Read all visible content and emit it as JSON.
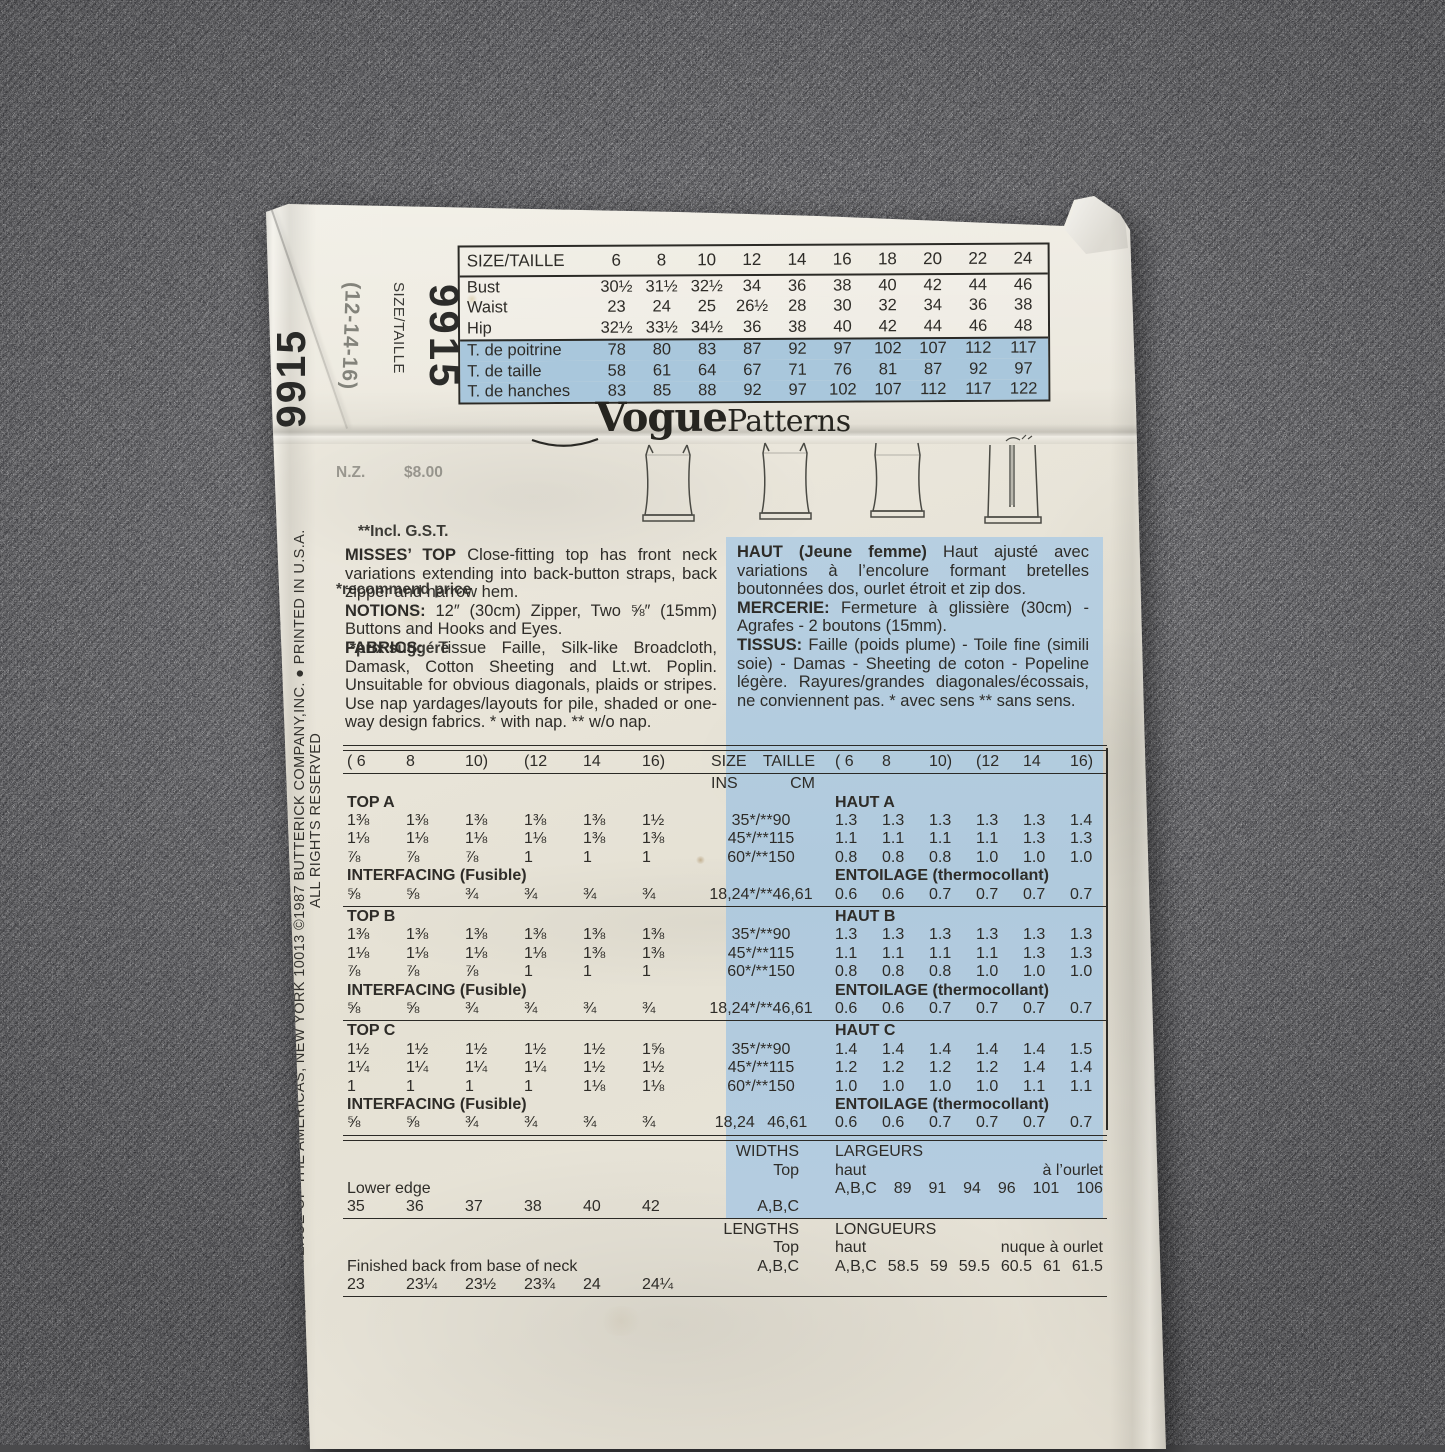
{
  "flap": {
    "pattern_number": "9915",
    "size_label": "SIZE/TAILLE",
    "size_range": "(12-14-16)"
  },
  "edge": {
    "pattern_number": "9915",
    "address_line1": "PATTERN SERVICE, 161 AVENUE OF THE AMERICAS, NEW YORK 10013   ©1987 BUTTERICK COMPANY,INC. ● PRINTED IN U.S.A.",
    "address_line2": "ALL RIGHTS RESERVED"
  },
  "brand": {
    "logo_bold": "Vogue",
    "logo_regular": "Patterns"
  },
  "price": {
    "line0": "N.Z.         $8.00",
    "line1": "**Incl. G.S.T.",
    "line2": "*recommend price",
    "line3": "*prix suggéré"
  },
  "size_table": {
    "header_label": "SIZE/TAILLE",
    "header_sizes": [
      "6",
      "8",
      "10",
      "12",
      "14",
      "16",
      "18",
      "20",
      "22",
      "24"
    ],
    "rows_en": [
      {
        "label": "Bust",
        "values": [
          "30½",
          "31½",
          "32½",
          "34",
          "36",
          "38",
          "40",
          "42",
          "44",
          "46"
        ]
      },
      {
        "label": "Waist",
        "values": [
          "23",
          "24",
          "25",
          "26½",
          "28",
          "30",
          "32",
          "34",
          "36",
          "38"
        ]
      },
      {
        "label": "Hip",
        "values": [
          "32½",
          "33½",
          "34½",
          "36",
          "38",
          "40",
          "42",
          "44",
          "46",
          "48"
        ]
      }
    ],
    "rows_fr": [
      {
        "label": "T. de poitrine",
        "values": [
          "78",
          "80",
          "83",
          "87",
          "92",
          "97",
          "102",
          "107",
          "112",
          "117"
        ]
      },
      {
        "label": "T. de taille",
        "values": [
          "58",
          "61",
          "64",
          "67",
          "71",
          "76",
          "81",
          "87",
          "92",
          "97"
        ]
      },
      {
        "label": "T. de hanches",
        "values": [
          "83",
          "85",
          "88",
          "92",
          "97",
          "102",
          "107",
          "112",
          "117",
          "122"
        ]
      }
    ]
  },
  "description_en": {
    "p1_b": "MISSES’ TOP",
    "p1_t": " Close-fitting top has front neck variations extending into back-button straps, back zipper and narrow hem.",
    "p2_b": "NOTIONS:",
    "p2_t": " 12″ (30cm) Zipper, Two ⅝″ (15mm) Buttons and Hooks and Eyes.",
    "p3_b": "FABRICS:",
    "p3_t": " Tissue Faille, Silk-like Broadcloth, Damask, Cotton Sheeting and Lt.wt. Poplin. Unsuitable for obvious diagonals, plaids or stripes. Use nap yardages/layouts for pile, shaded or one-way design fabrics. * with nap. ** w/o nap."
  },
  "description_fr": {
    "p1_b": "HAUT (Jeune femme)",
    "p1_t": " Haut ajusté avec variations à l’encolure formant bretelles boutonnées dos, ourlet étroit et zip dos.",
    "p2_b": "MERCERIE:",
    "p2_t": " Fermeture à glissière (30cm) - Agrafes - 2 boutons (15mm).",
    "p3_b": "TISSUS:",
    "p3_t": " Faille (poids plume) - Toile fine (simili soie) - Damas - Sheeting de coton - Popeline légère. Rayures/grandes diagonales/écossais, ne conviennent pas. * avec sens ** sans sens."
  },
  "yardage": {
    "size_header_en": [
      "( 6",
      "8",
      "10)",
      "(12",
      "14",
      "16)"
    ],
    "size_header_fr": [
      "( 6",
      "8",
      "10)",
      "(12",
      "14",
      "16)"
    ],
    "col_size": "SIZE",
    "col_taille": "TAILLE",
    "col_ins": "INS",
    "col_cm": "CM",
    "sections": [
      {
        "name_en": "TOP A",
        "name_fr": "HAUT A",
        "rows": [
          {
            "en": [
              "1⅜",
              "1⅜",
              "1⅜",
              "1⅜",
              "1⅜",
              "1½"
            ],
            "width": "35*/**90",
            "fr": [
              "1.3",
              "1.3",
              "1.3",
              "1.3",
              "1.3",
              "1.4"
            ]
          },
          {
            "en": [
              "1⅛",
              "1⅛",
              "1⅛",
              "1⅛",
              "1⅜",
              "1⅜"
            ],
            "width": "45*/**115",
            "fr": [
              "1.1",
              "1.1",
              "1.1",
              "1.1",
              "1.3",
              "1.3"
            ]
          },
          {
            "en": [
              "⅞",
              "⅞",
              "⅞",
              "1",
              "1",
              "1"
            ],
            "width": "60*/**150",
            "fr": [
              "0.8",
              "0.8",
              "0.8",
              "1.0",
              "1.0",
              "1.0"
            ]
          }
        ],
        "interfacing": {
          "label_en": "INTERFACING (Fusible)",
          "label_fr": "ENTOILAGE (thermocollant)",
          "en": [
            "⅝",
            "⅝",
            "¾",
            "¾",
            "¾",
            "¾"
          ],
          "width": "18,24*/**46,61",
          "fr": [
            "0.6",
            "0.6",
            "0.7",
            "0.7",
            "0.7",
            "0.7"
          ]
        }
      },
      {
        "name_en": "TOP B",
        "name_fr": "HAUT B",
        "rows": [
          {
            "en": [
              "1⅜",
              "1⅜",
              "1⅜",
              "1⅜",
              "1⅜",
              "1⅜"
            ],
            "width": "35*/**90",
            "fr": [
              "1.3",
              "1.3",
              "1.3",
              "1.3",
              "1.3",
              "1.3"
            ]
          },
          {
            "en": [
              "1⅛",
              "1⅛",
              "1⅛",
              "1⅛",
              "1⅜",
              "1⅜"
            ],
            "width": "45*/**115",
            "fr": [
              "1.1",
              "1.1",
              "1.1",
              "1.1",
              "1.3",
              "1.3"
            ]
          },
          {
            "en": [
              "⅞",
              "⅞",
              "⅞",
              "1",
              "1",
              "1"
            ],
            "width": "60*/**150",
            "fr": [
              "0.8",
              "0.8",
              "0.8",
              "1.0",
              "1.0",
              "1.0"
            ]
          }
        ],
        "interfacing": {
          "label_en": "INTERFACING (Fusible)",
          "label_fr": "ENTOILAGE (thermocollant)",
          "en": [
            "⅝",
            "⅝",
            "¾",
            "¾",
            "¾",
            "¾"
          ],
          "width": "18,24*/**46,61",
          "fr": [
            "0.6",
            "0.6",
            "0.7",
            "0.7",
            "0.7",
            "0.7"
          ]
        }
      },
      {
        "name_en": "TOP C",
        "name_fr": "HAUT C",
        "rows": [
          {
            "en": [
              "1½",
              "1½",
              "1½",
              "1½",
              "1½",
              "1⅝"
            ],
            "width": "35*/**90",
            "fr": [
              "1.4",
              "1.4",
              "1.4",
              "1.4",
              "1.4",
              "1.5"
            ]
          },
          {
            "en": [
              "1¼",
              "1¼",
              "1¼",
              "1¼",
              "1½",
              "1½"
            ],
            "width": "45*/**115",
            "fr": [
              "1.2",
              "1.2",
              "1.2",
              "1.2",
              "1.4",
              "1.4"
            ]
          },
          {
            "en": [
              "1",
              "1",
              "1",
              "1",
              "1⅛",
              "1⅛"
            ],
            "width": "60*/**150",
            "fr": [
              "1.0",
              "1.0",
              "1.0",
              "1.0",
              "1.1",
              "1.1"
            ]
          }
        ],
        "interfacing": {
          "label_en": "INTERFACING (Fusible)",
          "label_fr": "ENTOILAGE (thermocollant)",
          "en": [
            "⅝",
            "⅝",
            "¾",
            "¾",
            "¾",
            "¾"
          ],
          "width": "18,24  46,61",
          "fr": [
            "0.6",
            "0.6",
            "0.7",
            "0.7",
            "0.7",
            "0.7"
          ]
        }
      }
    ]
  },
  "widths": {
    "title_en": "WIDTHS",
    "sub_en": "Top",
    "views_en": "A,B,C",
    "row_label": "Lower edge",
    "values_en": [
      "35",
      "36",
      "37",
      "38",
      "40",
      "42"
    ],
    "title_fr": "LARGEURS",
    "sub_fr": "haut",
    "views_fr": "A,B,C",
    "values_fr": [
      "89",
      "91",
      "94",
      "96",
      "101",
      "106"
    ],
    "note_fr": "à l’ourlet"
  },
  "lengths": {
    "title_en": "LENGTHS",
    "sub_en": "Top",
    "views_en": "A,B,C",
    "row_label": "Finished back from base of neck",
    "values_en": [
      "23",
      "23¼",
      "23½",
      "23¾",
      "24",
      "24¼"
    ],
    "title_fr": "LONGUEURS",
    "sub_fr": "haut",
    "views_fr": "A,B,C",
    "values_fr": [
      "58.5",
      "59",
      "59.5",
      "60.5",
      "61",
      "61.5"
    ],
    "note_fr": "nuque à ourlet"
  },
  "colors": {
    "paper": "#e8e4d8",
    "blue_panel": "#b3cbde",
    "blue_table_rows": "#a9c7dc",
    "ink": "#2e2c28",
    "fabric_base": "#4a4a4c"
  },
  "drawings": [
    "top-back-view-a",
    "top-back-view-b",
    "top-back-view-c",
    "top-back-view-zipper"
  ]
}
